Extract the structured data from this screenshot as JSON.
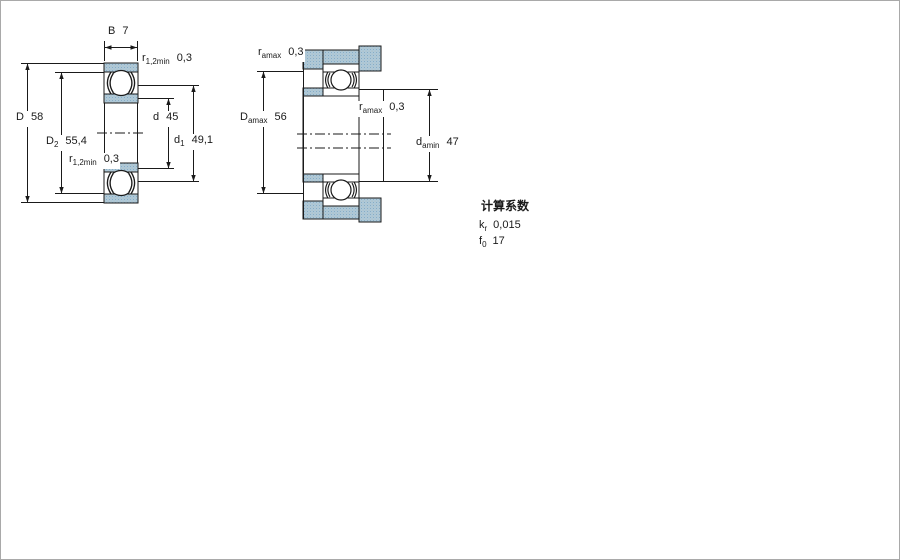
{
  "colors": {
    "section_fill": "#adc9da",
    "line": "#1a1a1a"
  },
  "left_view": {
    "B": {
      "sym": "B",
      "sub": "",
      "val": "7"
    },
    "r12_top": {
      "sym": "r",
      "sub": "1,2min",
      "val": "0,3"
    },
    "D": {
      "sym": "D",
      "sub": "",
      "val": "58"
    },
    "D2": {
      "sym": "D",
      "sub": "2",
      "val": "55,4"
    },
    "r12_bottom": {
      "sym": "r",
      "sub": "1,2min",
      "val": "0,3"
    },
    "d": {
      "sym": "d",
      "sub": "",
      "val": "45"
    },
    "d1": {
      "sym": "d",
      "sub": "1",
      "val": "49,1"
    }
  },
  "right_view": {
    "ra_top": {
      "sym": "r",
      "sub": "amax",
      "val": "0,3"
    },
    "Da": {
      "sym": "D",
      "sub": "amax",
      "val": "56"
    },
    "ra_mid": {
      "sym": "r",
      "sub": "amax",
      "val": "0,3"
    },
    "da": {
      "sym": "d",
      "sub": "amin",
      "val": "47"
    }
  },
  "calc": {
    "title": "计算系数",
    "rows": [
      {
        "sym": "k",
        "sub": "r",
        "val": "0,015"
      },
      {
        "sym": "f",
        "sub": "0",
        "val": "17"
      }
    ]
  }
}
